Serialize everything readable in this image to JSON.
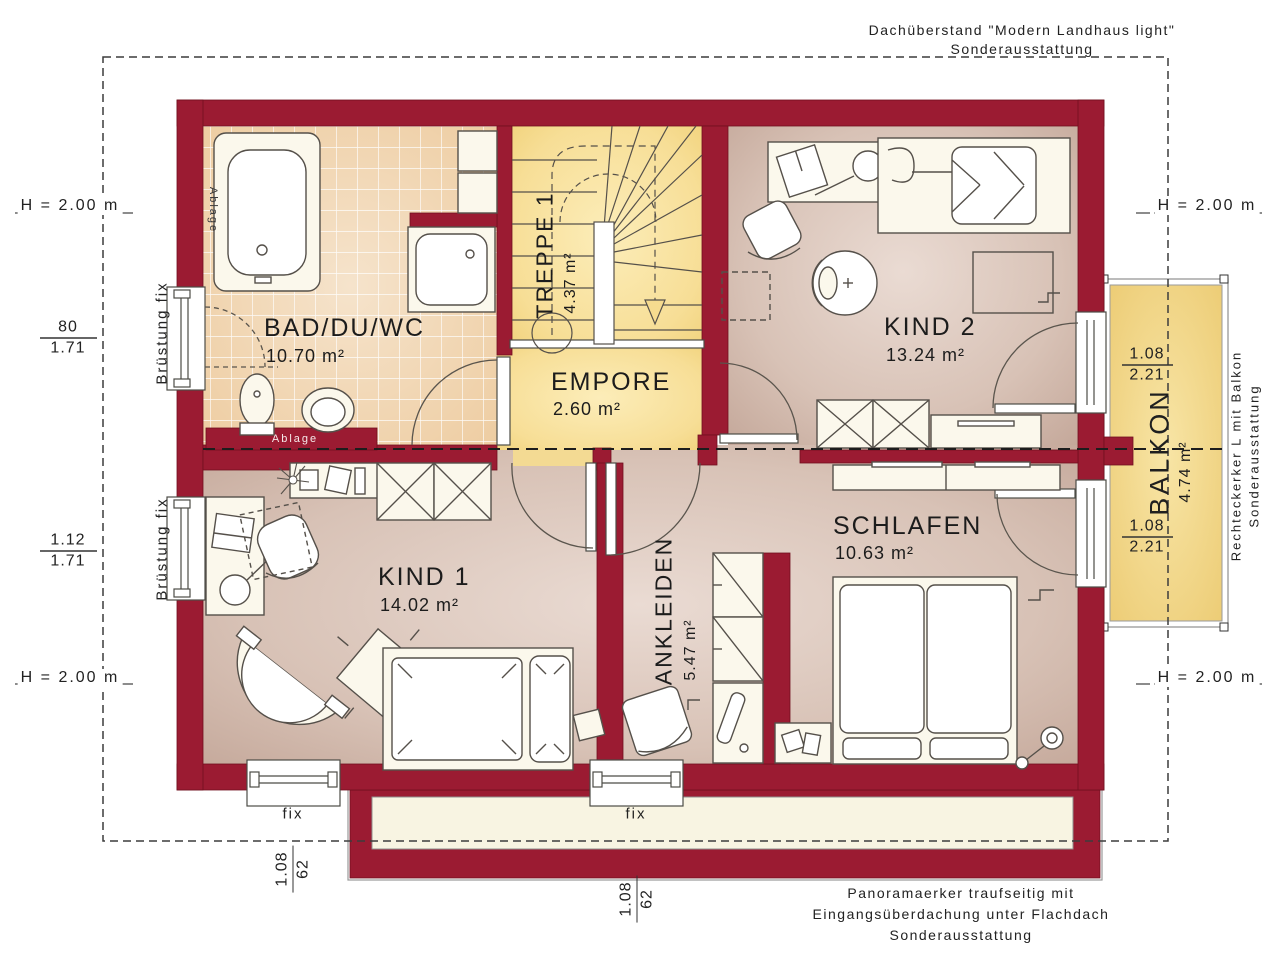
{
  "notes": {
    "top_right_1": "Dachüberstand \"Modern Landhaus light\"",
    "top_right_2": "Sonderausstattung",
    "bottom_right_1": "Panoramaerker traufseitig mit",
    "bottom_right_2": "Eingangsüberdachung unter Flachdach",
    "bottom_right_3": "Sonderausstattung",
    "right_side_1": "Rechteckerker L mit Balkon",
    "right_side_2": "Sonderausstattung"
  },
  "marks": {
    "h": "H = 2.00 m"
  },
  "rooms": {
    "bad": {
      "name": "BAD/DU/WC",
      "area": "10.70 m²"
    },
    "treppe": {
      "name": "TREPPE 1",
      "area": "4.37 m²"
    },
    "empore": {
      "name": "EMPORE",
      "area": "2.60 m²"
    },
    "kind2": {
      "name": "KIND 2",
      "area": "13.24 m²"
    },
    "kind1": {
      "name": "KIND 1",
      "area": "14.02 m²"
    },
    "ankleiden": {
      "name": "ANKLEIDEN",
      "area": "5.47 m²"
    },
    "schlafen": {
      "name": "SCHLAFEN",
      "area": "10.63 m²"
    },
    "balkon": {
      "name": "BALKON",
      "area": "4.74 m²"
    }
  },
  "window_labels": {
    "bruestung": "Brüstung fix",
    "fix": "fix"
  },
  "shelf_label": "Ablage",
  "dimensions": {
    "left_top": {
      "n": "80",
      "d": "1.71"
    },
    "left_bottom": {
      "n": "1.12",
      "d": "1.71"
    },
    "balkon_top": {
      "n": "1.08",
      "d": "2.21"
    },
    "balkon_bottom": {
      "n": "1.08",
      "d": "2.21"
    },
    "south_left": {
      "n": "1.08",
      "d": "62"
    },
    "south_mid": {
      "n": "1.08",
      "d": "62"
    }
  },
  "colors": {
    "wall": "#9B1B32",
    "bath_tile": "#EECDA2",
    "floor": "#D9C4B8",
    "yellow": "#F6DB8F",
    "balkon": "#F2D382",
    "erker_inner": "#F8F4E2"
  }
}
